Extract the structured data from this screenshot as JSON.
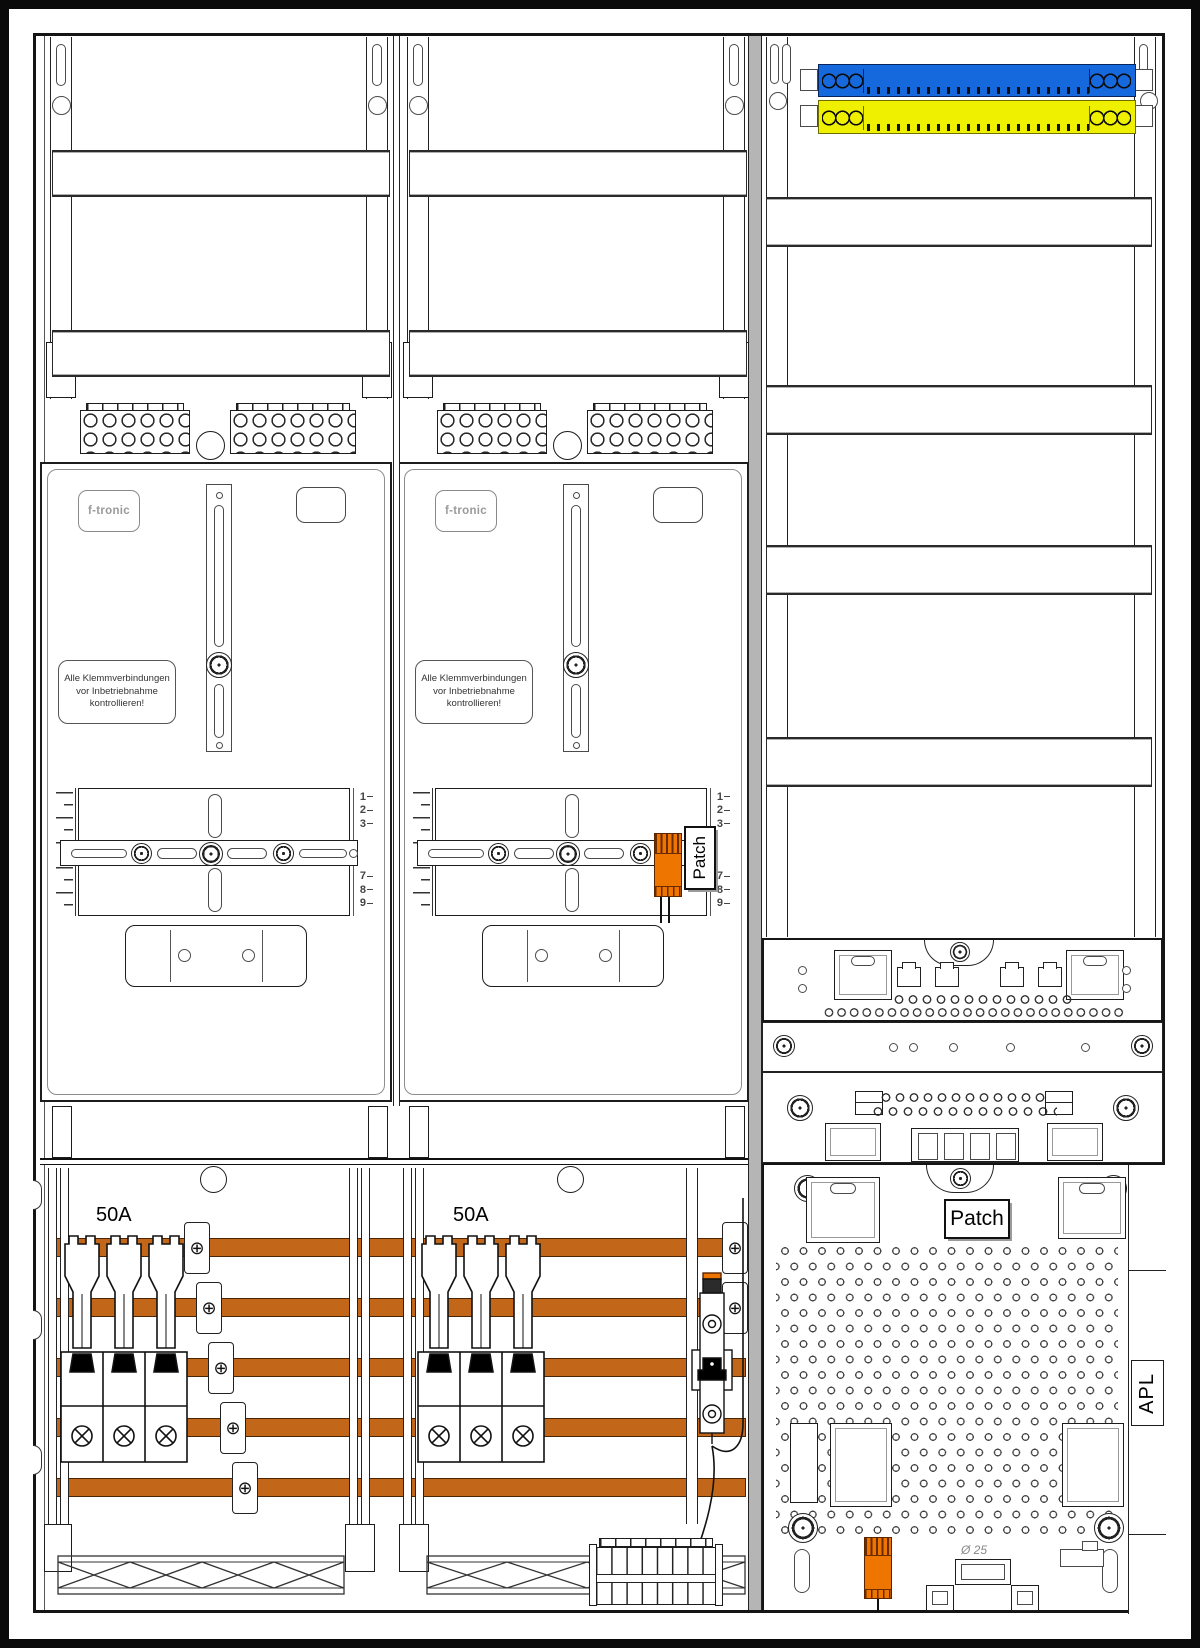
{
  "colors": {
    "busbar_orange": "#C2661A",
    "component_orange": "#EE7500",
    "neutral_bar_blue": "#1668DD",
    "pe_bar_yellow": "#EFEF00",
    "outline": "#1A1A1A"
  },
  "icons": {
    "screw_cross": "⊕"
  },
  "meter_fields": [
    {
      "brand_label": "f-tronic",
      "warning_label": "Alle Klemmverbindungen\nvor Inbetriebnahme\nkontrollieren!",
      "scale_upper": [
        "1",
        "2",
        "3"
      ],
      "scale_lower": [
        "7",
        "8",
        "9"
      ],
      "breaker_rating": "50A"
    },
    {
      "brand_label": "f-tronic",
      "warning_label": "Alle Klemmverbindungen\nvor Inbetriebnahme\nkontrollieren!",
      "scale_upper": [
        "1",
        "2",
        "3"
      ],
      "scale_lower": [
        "7",
        "8",
        "9"
      ],
      "breaker_rating": "50A",
      "patch_label": "Patch"
    }
  ],
  "distribution_field": {
    "patch_label": "Patch",
    "apl_label": "APL",
    "grommet_diameter_label": "Ø 25"
  }
}
